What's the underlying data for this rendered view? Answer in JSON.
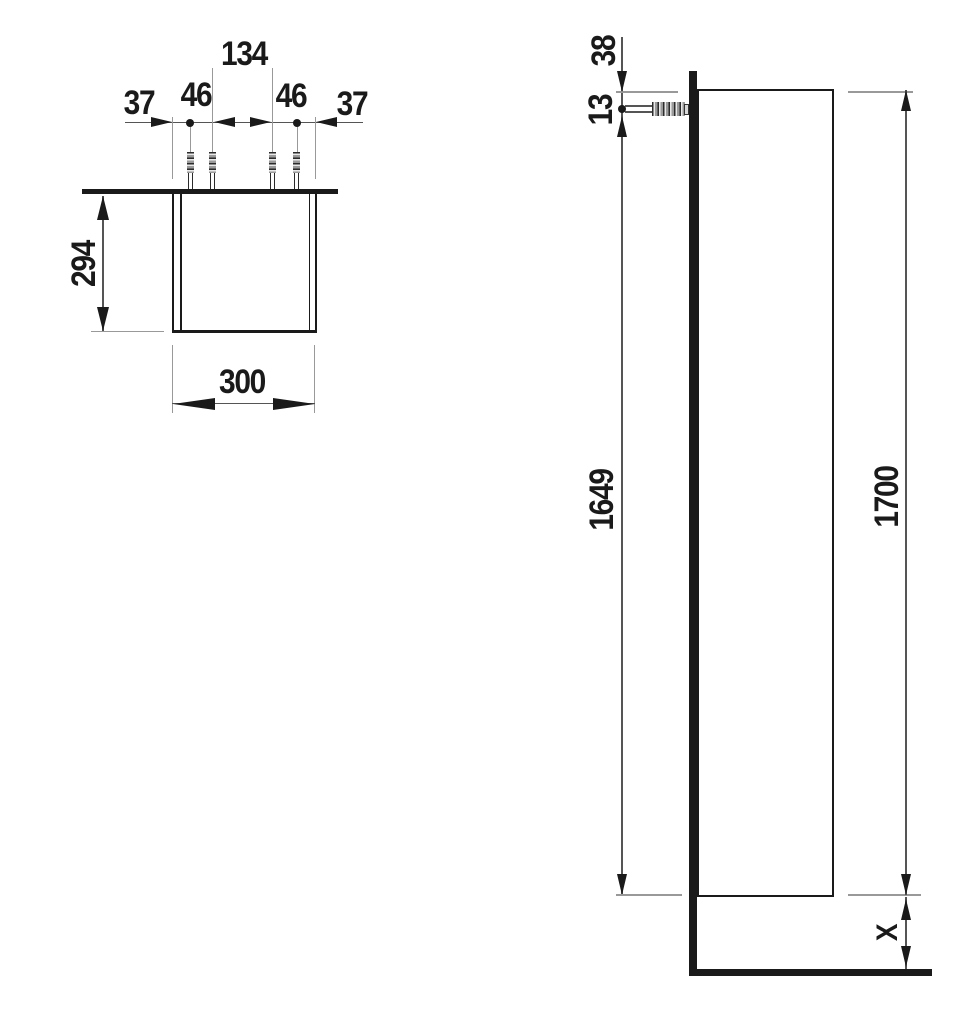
{
  "drawing": {
    "front_view": {
      "chain": {
        "d134": "134",
        "d37_left": "37",
        "d46_left": "46",
        "d46_right": "46",
        "d37_right": "37"
      },
      "height": "294",
      "width": "300"
    },
    "side_view": {
      "top_to_screw": "38",
      "screw_offset": "13",
      "screw_to_bottom": "1649",
      "total_height": "1700",
      "floor_clearance": "X"
    }
  },
  "colors": {
    "ink": "#1a1a1a",
    "dim_line": "#555555",
    "ext_line": "#999999",
    "bg": "#ffffff"
  }
}
